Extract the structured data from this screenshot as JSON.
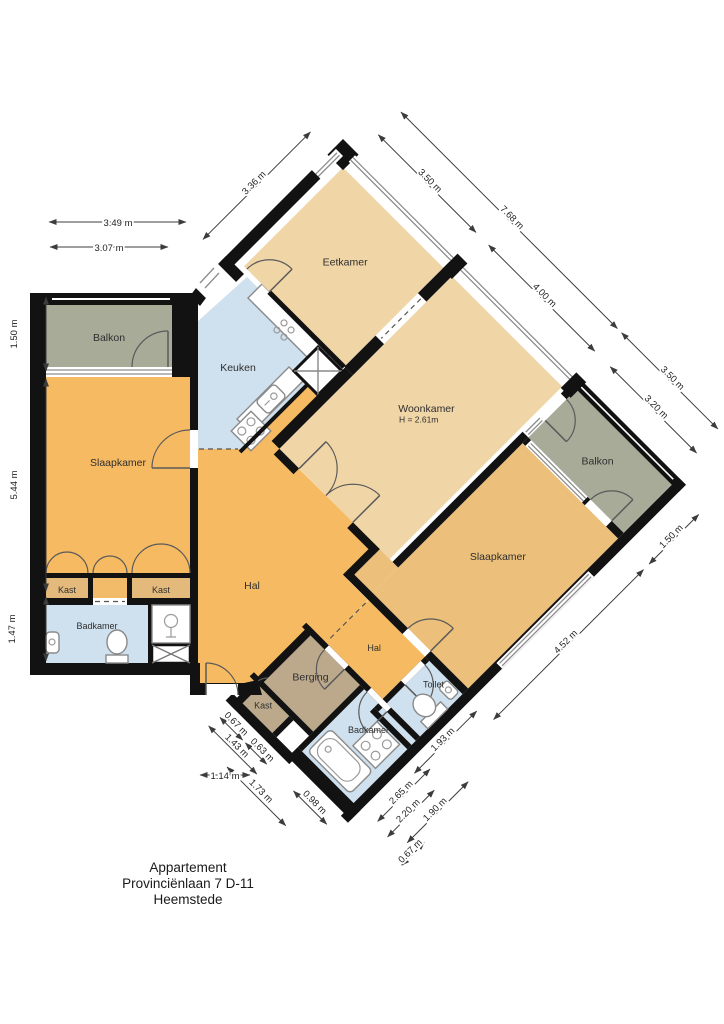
{
  "title": {
    "line1": "Appartement",
    "line2": "Provinciënlaan 7 D-11",
    "line3": "Heemstede"
  },
  "rooms": {
    "balkon_left": "Balkon",
    "slaapkamer_left": "Slaapkamer",
    "kast_a": "Kast",
    "kast_b": "Kast",
    "badkamer_left": "Badkamer",
    "keuken": "Keuken",
    "eetkamer": "Eetkamer",
    "woonkamer": "Woonkamer",
    "woonkamer_height": "H = 2.61m",
    "hal_main": "Hal",
    "hal_small": "Hal",
    "berging": "Berging",
    "kast_c": "Kast",
    "badkamer_small": "Badkamer",
    "toilet": "Toilet",
    "slaapkamer_right": "Slaapkamer",
    "balkon_right": "Balkon"
  },
  "dimensions": {
    "top_outer": "3.49 m",
    "top_inner": "3.07 m",
    "left_balkon": "1.50 m",
    "left_slaapkamer": "5.44 m",
    "left_badkamer": "1.47 m",
    "nw_eetkamer": "3.36 m",
    "ne_eetkamer": "3.50 m",
    "ne_total": "7.68 m",
    "ne_woonkamer": "4.00 m",
    "ne_balkon_outer": "3.50 m",
    "ne_balkon_inner": "3.20 m",
    "se_balkon": "1.50 m",
    "se_slaapkamer": "4.52 m",
    "se_toilet": "1.93 m",
    "br_badkamer": "2.65 m",
    "br_inner": "2.20 m",
    "br_toilet": "1.90 m",
    "br_small": "0.67 m",
    "bl_kast": "0.67 m",
    "bl_kast2": "0.63 m",
    "bl_berging": "1.43 m",
    "bl_horizontal": "1.14 m",
    "bl_diag1": "1.73 m",
    "bl_diag2": "0.98 m"
  },
  "colors": {
    "floor_tan": "#f0d5a7",
    "floor_orange": "#f6ba62",
    "floor_slaap_right": "#ecbf7b",
    "floor_kast": "#e3ba7c",
    "floor_passage": "#f2bb69",
    "floor_blue": "#cfe0ee",
    "floor_balkon": "#a9ab99",
    "floor_taupe": "#bca98c",
    "wall": "#121212"
  }
}
